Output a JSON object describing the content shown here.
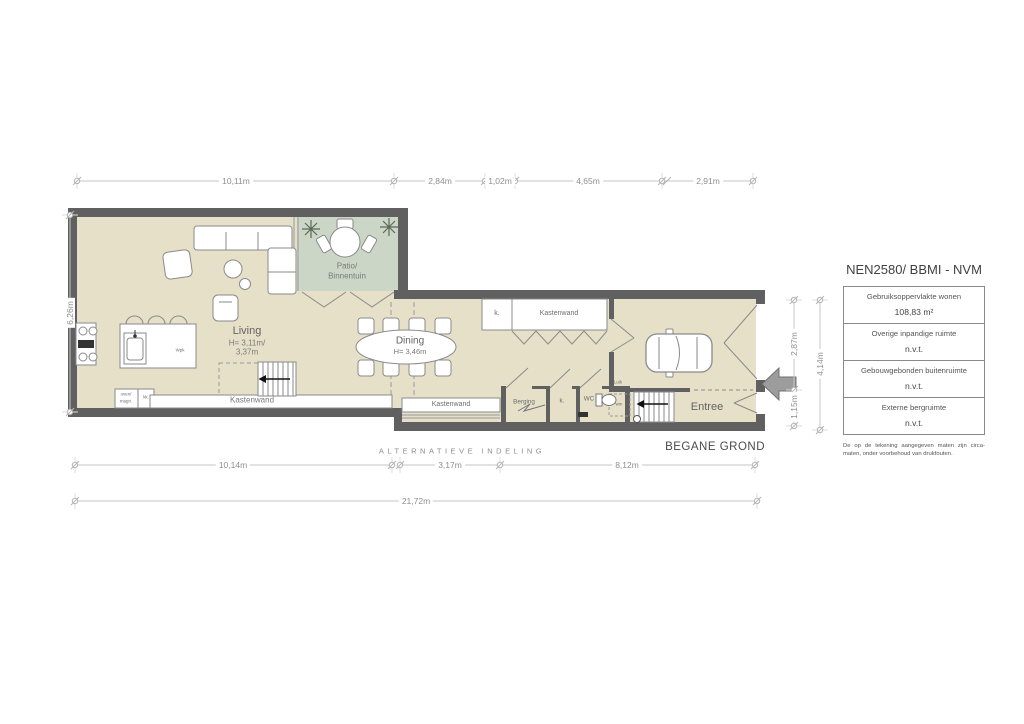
{
  "plan": {
    "floor_name": "BEGANE GROND",
    "variant_note": "ALTERNATIEVE INDELING",
    "rooms": {
      "living": {
        "label": "Living",
        "h1": "H= 3,11m/",
        "h2": "3,37m"
      },
      "dining": {
        "label": "Dining",
        "h": "H= 3,46m"
      },
      "patio": {
        "l1": "Patio/",
        "l2": "Binnentuin"
      },
      "entree": {
        "label": "Entree"
      },
      "berging": {
        "label": "Berging"
      },
      "wc": {
        "label": "WC"
      },
      "closet_k_top": "k.",
      "closet_k_hall": "k.",
      "kastenwand_top": "Kastenwand",
      "kastenwand_living": "Kastenwand",
      "kastenwand_hall": "Kastenwand",
      "oven": "oven/",
      "magn": "magn.",
      "kk": "kk.",
      "wpk": "Wpk",
      "luik": "Luik",
      "wm": "wm"
    }
  },
  "dimensions": {
    "top": [
      "10,11m",
      "2,84m",
      "1,02m",
      "4,65m",
      "2,91m"
    ],
    "left": "6,26m",
    "right": {
      "upper": "2,87m",
      "lower": "1,15m",
      "total": "4,14m"
    },
    "bottom": [
      "10,14m",
      "3,17m",
      "8,12m"
    ],
    "bottom_total": "21,72m"
  },
  "info_table": {
    "title": "NEN2580/ BBMI - NVM",
    "rows": [
      {
        "label": "Gebruiksoppervlakte wonen",
        "value": "108,83 m²"
      },
      {
        "label": "Overige inpandige ruimte",
        "value": "n.v.t."
      },
      {
        "label": "Gebouwgebonden buitenruimte",
        "value": "n.v.t."
      },
      {
        "label": "Externe bergruimte",
        "value": "n.v.t."
      }
    ],
    "note": "De op de tekening aangegeven maten zijn circa-maten, onder voorbehoud van drukfouten."
  },
  "colors": {
    "floor": "#e6e0c9",
    "patio": "#ccd6c6",
    "wall": "#606060",
    "dim_line": "#c6c6c6"
  }
}
